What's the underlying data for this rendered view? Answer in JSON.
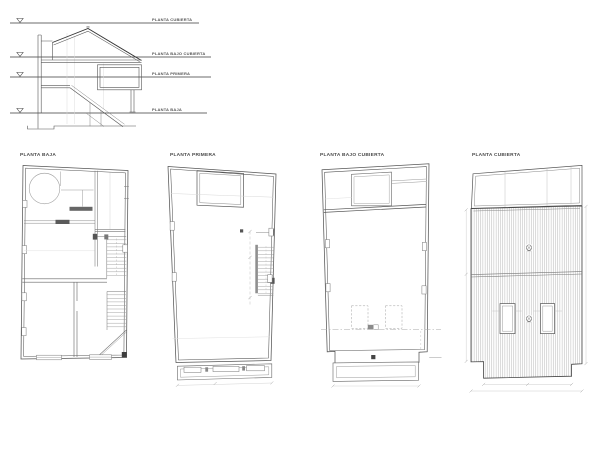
{
  "sheet": {
    "background_color": "#ffffff",
    "line_color": "#555555",
    "dark_line_color": "#3d3d3d",
    "light_line_color": "#c0c0c0",
    "roof_hatch_color": "#b4b4b4"
  },
  "section_drawing": {
    "levels": [
      {
        "label": "PLANTA CUBIERTA"
      },
      {
        "label": "PLANTA BAJO CUBIERTA"
      },
      {
        "label": "PLANTA PRIMERA"
      },
      {
        "label": "PLANTA BAJA"
      }
    ]
  },
  "floor_plans": [
    {
      "title": "PLANTA BAJA"
    },
    {
      "title": "PLANTA PRIMERA"
    },
    {
      "title": "PLANTA BAJO CUBIERTA"
    },
    {
      "title": "PLANTA CUBIERTA"
    }
  ]
}
